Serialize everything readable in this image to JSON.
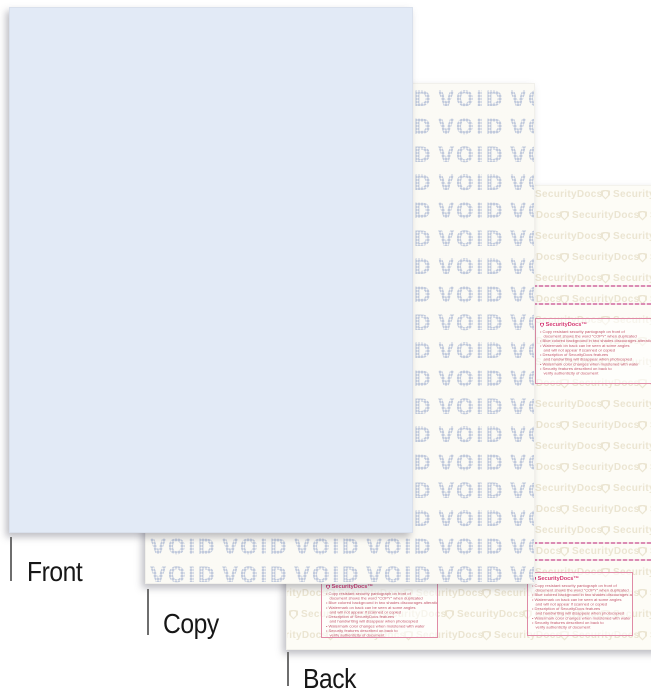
{
  "labels": {
    "front": "Front",
    "copy": "Copy",
    "back": "Back"
  },
  "copy_sheet": {
    "void_word": "VOID"
  },
  "back_sheet": {
    "watermark_text": "SecurityDocs",
    "info_box": {
      "header": "SecurityDocs™",
      "lines": [
        {
          "bullet": true,
          "text": "Copy resistant security pantograph on front of"
        },
        {
          "bullet": false,
          "text": "document shows the word \"COPY\" when duplicated"
        },
        {
          "bullet": true,
          "text": "Blue colored background in two shades discourages alterations"
        },
        {
          "bullet": true,
          "text": "Watermark on back can be seen at some angles"
        },
        {
          "bullet": false,
          "text": "and will not appear if scanned or copied"
        },
        {
          "bullet": true,
          "text": "Description of SecurityDocs features"
        },
        {
          "bullet": false,
          "text": "and handwriting will disappear when photocopied"
        },
        {
          "bullet": true,
          "text": "Watermark color changes when moistened with water"
        },
        {
          "bullet": true,
          "text": "Security features described on back to"
        },
        {
          "bullet": false,
          "text": "verify authenticity of document"
        }
      ]
    }
  },
  "colors": {
    "front_sheet": "#e2eaf6",
    "copy_sheet_bg": "#fbfaf5",
    "back_sheet_bg": "#fdfcf6",
    "void_text": "#bfc9dc",
    "watermark_tan": "#ebe5d2",
    "accent_pink": "#d53a74",
    "signature_line_pink": "#db8cb4",
    "label_text": "#171717"
  }
}
